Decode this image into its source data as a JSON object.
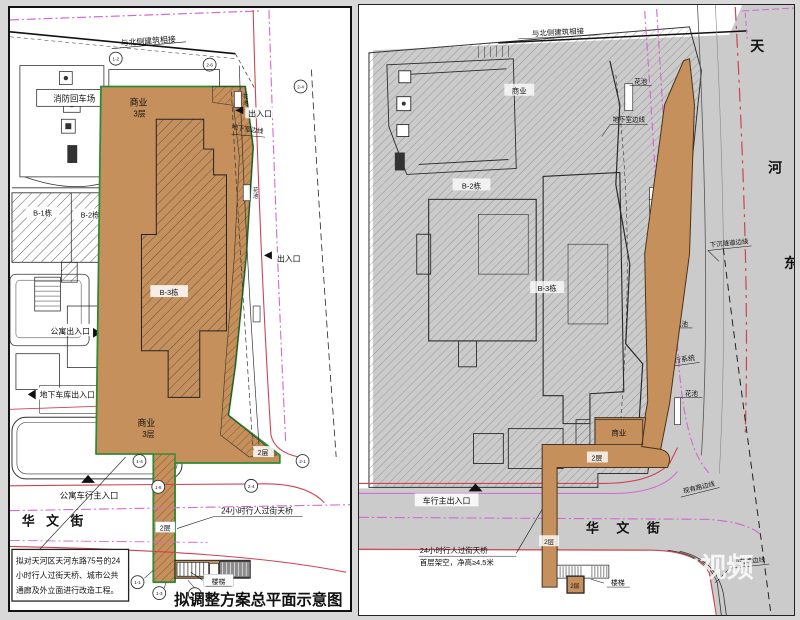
{
  "colors": {
    "orange": "#c6905c",
    "green": "#2e8b34",
    "magenta": "#d565d5",
    "red": "#cf4252",
    "road_gray": "#cbcbcb"
  },
  "watermark": {
    "brand": "N视频"
  },
  "left_panel": {
    "title": "拟调整方案总平面示意图",
    "north_link": "与北侧建筑相接",
    "fire_turnaround": "消防回车场",
    "commercial": "商业",
    "floors_3": "3层",
    "b1": "B-1栋",
    "b2": "B-2栋",
    "b3": "B-3栋",
    "entrance": "出入口",
    "basement_edge": "地下室边线",
    "planter_chars": [
      "花",
      "池"
    ],
    "apartment_entrance": "公寓出入口",
    "garage_entrance": "地下车库出入口",
    "level_2": "2层",
    "apartment_vehicle_entrance": "公寓车行主入口",
    "street_name": "华 文 街",
    "footbridge": "24小时行人过街天桥",
    "stairs": "楼梯",
    "note_lines": [
      "拟对天河区天河东路75号的24",
      "小时行人过街天桥、城市公共",
      "通廊及外立面进行改造工程。"
    ],
    "axis_bubbles": [
      "1-2",
      "2-6",
      "2-4",
      "1-4",
      "1-8",
      "2-4",
      "2-1",
      "1-1",
      "1-3",
      "1-5"
    ]
  },
  "right_panel": {
    "north_link": "与北侧建筑相接",
    "commercial": "商业",
    "b2": "B-2栋",
    "b3": "B-3栋",
    "planter": "花池",
    "basement_edge": "地下室边线",
    "tunnel_edge": "下沉隧道边线",
    "walkway_system": "二层步行系统",
    "existing_road_edge": "现有路边线",
    "level_2": "2层",
    "vehicle_entrance": "车行主出入口",
    "street_name": "华 文 街",
    "road_name_chars": [
      "天",
      "河",
      "东"
    ],
    "footbridge_line1": "24小时行人过街天桥",
    "footbridge_line2": "首层架空，净高≥4.5米",
    "stairs": "楼梯"
  }
}
